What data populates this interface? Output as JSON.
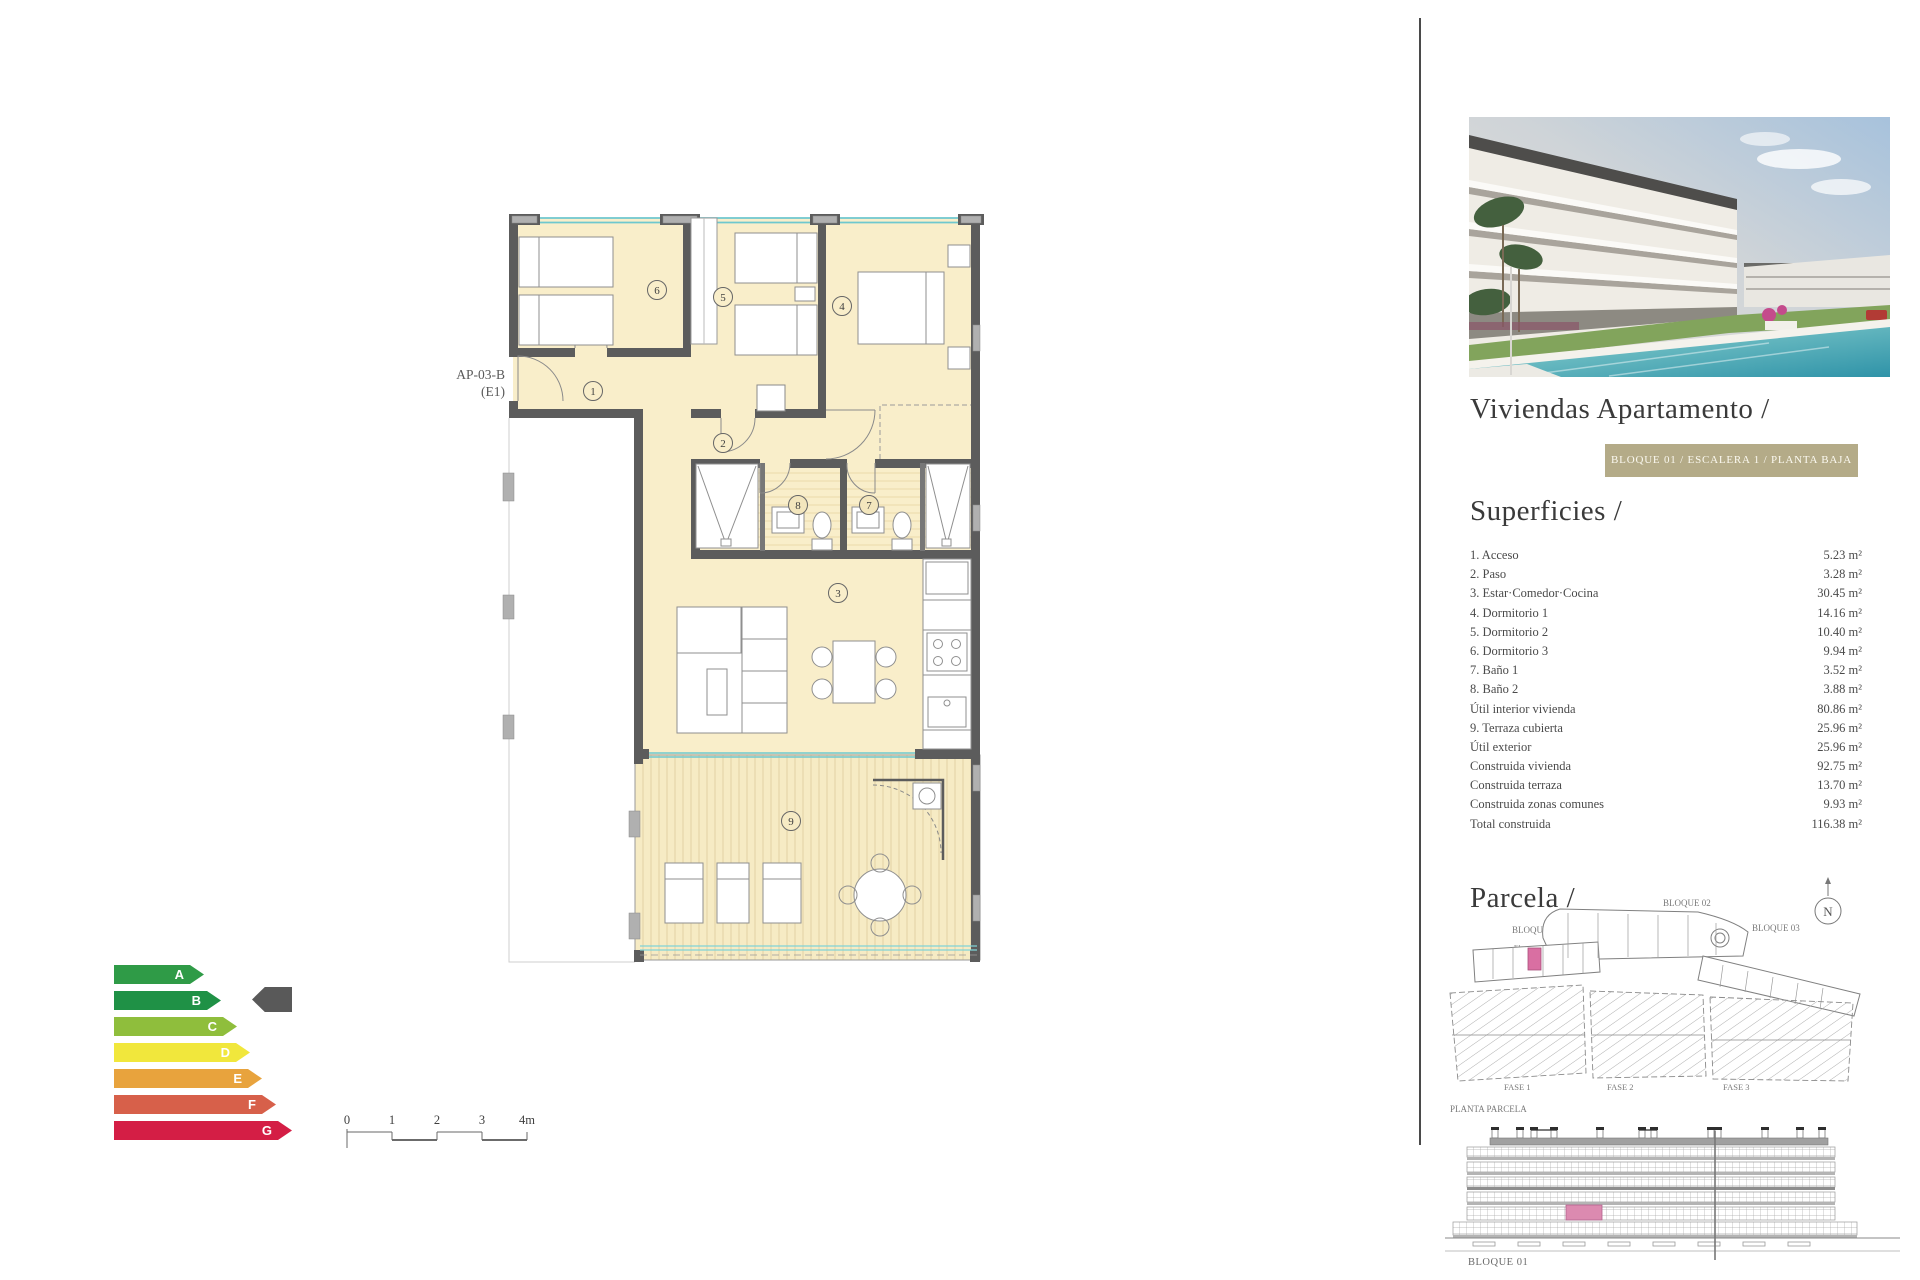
{
  "floor_plan": {
    "unit_label_line1": "AP-03-B",
    "unit_label_line2": "(E1)",
    "room_numbers": [
      "1",
      "2",
      "3",
      "4",
      "5",
      "6",
      "7",
      "8",
      "9"
    ],
    "colors": {
      "floor": "#f9eeca",
      "terrace": "#f6ebc4",
      "wall": "#5c5c5c",
      "window": "#6fc8ce",
      "pillar": "#b0b0b0"
    }
  },
  "energy_rating": {
    "scale": [
      {
        "letter": "A",
        "color": "#2f9b47",
        "width_px": 90
      },
      {
        "letter": "B",
        "color": "#1f9146",
        "width_px": 107
      },
      {
        "letter": "C",
        "color": "#8fbe3c",
        "width_px": 123
      },
      {
        "letter": "D",
        "color": "#f1e73c",
        "width_px": 136
      },
      {
        "letter": "E",
        "color": "#e8a33d",
        "width_px": 148
      },
      {
        "letter": "F",
        "color": "#d7604a",
        "width_px": 162
      },
      {
        "letter": "G",
        "color": "#d41e45",
        "width_px": 178
      }
    ],
    "selected": "B",
    "indicator_color": "#595959"
  },
  "scale_bar": {
    "labels": [
      "0",
      "1",
      "2",
      "3",
      "4m"
    ]
  },
  "right_panel": {
    "title": "Viviendas Apartamento /",
    "badge": "BLOQUE 01 / ESCALERA 1 / PLANTA BAJA",
    "superficies": {
      "heading": "Superficies /",
      "rows": [
        {
          "label": "1. Acceso",
          "value": "5.23 m²"
        },
        {
          "label": "2. Paso",
          "value": "3.28 m²"
        },
        {
          "label": "3. Estar·Comedor·Cocina",
          "value": "30.45 m²"
        },
        {
          "label": "4. Dormitorio 1",
          "value": "14.16 m²"
        },
        {
          "label": "5. Dormitorio 2",
          "value": "10.40 m²"
        },
        {
          "label": "6. Dormitorio 3",
          "value": "9.94 m²"
        },
        {
          "label": "7. Baño 1",
          "value": "3.52 m²"
        },
        {
          "label": "8. Baño 2",
          "value": "3.88 m²"
        },
        {
          "label": "Útil interior vivienda",
          "value": "80.86 m²"
        },
        {
          "label": "9. Terraza cubierta",
          "value": "25.96 m²"
        },
        {
          "label": "Útil exterior",
          "value": "25.96 m²"
        },
        {
          "label": "Construida vivienda",
          "value": "92.75 m²"
        },
        {
          "label": "Construida terraza",
          "value": "13.70 m²"
        },
        {
          "label": "Construida zonas comunes",
          "value": "9.93 m²"
        },
        {
          "label": "Total construida",
          "value": "116.38 m²"
        }
      ]
    },
    "parcela": {
      "heading": "Parcela /",
      "block_labels": [
        "BLOQUE 01",
        "BLOQUE 02",
        "BLOQUE 03"
      ],
      "stair_labels": [
        "E1",
        "E2",
        "E3"
      ],
      "fase_labels": [
        "FASE 1",
        "FASE 2",
        "FASE 3"
      ],
      "caption": "PLANTA PARCELA",
      "compass": "N"
    },
    "elevation": {
      "caption": "BLOQUE 01"
    }
  }
}
